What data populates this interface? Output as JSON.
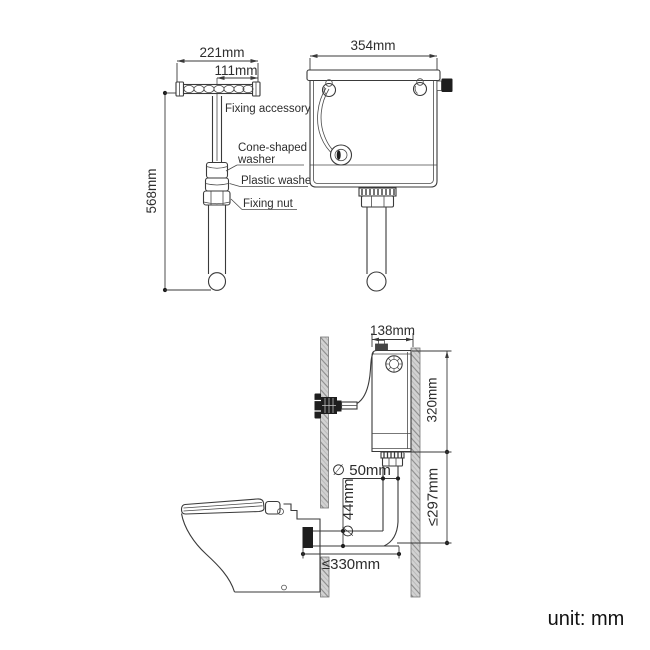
{
  "unit_label": "unit: mm",
  "exploded_view": {
    "dim_width_total": "221mm",
    "dim_width_half": "111mm",
    "dim_height": "568mm",
    "fixing_accessory": "Fixing accessory",
    "cone_washer_line1": "Cone-shaped",
    "cone_washer_line2": "washer",
    "plastic_washer": "Plastic washer",
    "fixing_nut": "Fixing nut"
  },
  "cistern_front_view": {
    "dim_width": "354mm"
  },
  "installation_view": {
    "dim_cistern_depth": "138mm",
    "dim_cistern_height": "320mm",
    "dim_flush_pipe_drop": "≤297mm",
    "dim_flush_pipe_diameter": "∅ 50mm",
    "dim_outlet_diameter": "∅ 44mm",
    "dim_setout": "≤330mm"
  },
  "colors": {
    "line": "#3a3a3a",
    "dark_fill": "#1e1e1e",
    "wall_fill": "#d2d2d2",
    "wall_hatch": "#8b8b8b",
    "text": "#2d2d2d",
    "background": "#ffffff"
  }
}
